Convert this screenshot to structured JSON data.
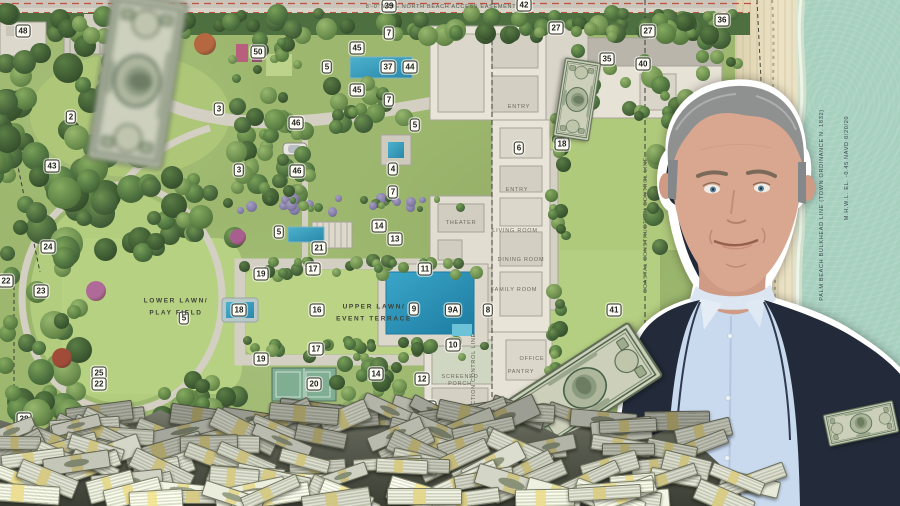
{
  "scene": {
    "description_labels": {
      "easement": "8'-0\" WIDE NORTH BEACH ACCESS EASEMENT"
    },
    "plan": {
      "badges": [
        {
          "n": "48",
          "x": 23,
          "y": 31
        },
        {
          "n": "50",
          "x": 258,
          "y": 52
        },
        {
          "n": "2",
          "x": 71,
          "y": 117
        },
        {
          "n": "3",
          "x": 219,
          "y": 109
        },
        {
          "n": "3",
          "x": 239,
          "y": 170
        },
        {
          "n": "46",
          "x": 296,
          "y": 123
        },
        {
          "n": "46",
          "x": 297,
          "y": 171
        },
        {
          "n": "43",
          "x": 52,
          "y": 166
        },
        {
          "n": "24",
          "x": 48,
          "y": 247
        },
        {
          "n": "22",
          "x": 6,
          "y": 281
        },
        {
          "n": "23",
          "x": 41,
          "y": 291
        },
        {
          "n": "25",
          "x": 99,
          "y": 373
        },
        {
          "n": "22",
          "x": 99,
          "y": 384
        },
        {
          "n": "28",
          "x": 24,
          "y": 419
        },
        {
          "n": "30",
          "x": 143,
          "y": 424
        },
        {
          "n": "29",
          "x": 413,
          "y": 425
        },
        {
          "n": "39",
          "x": 389,
          "y": 6
        },
        {
          "n": "42",
          "x": 524,
          "y": 5
        },
        {
          "n": "27",
          "x": 556,
          "y": 28
        },
        {
          "n": "27",
          "x": 648,
          "y": 31
        },
        {
          "n": "36",
          "x": 722,
          "y": 20
        },
        {
          "n": "35",
          "x": 607,
          "y": 59
        },
        {
          "n": "40",
          "x": 643,
          "y": 64
        },
        {
          "n": "7",
          "x": 389,
          "y": 33
        },
        {
          "n": "7",
          "x": 389,
          "y": 100
        },
        {
          "n": "7",
          "x": 393,
          "y": 192
        },
        {
          "n": "45",
          "x": 357,
          "y": 48
        },
        {
          "n": "45",
          "x": 357,
          "y": 90
        },
        {
          "n": "5",
          "x": 327,
          "y": 67
        },
        {
          "n": "37",
          "x": 388,
          "y": 67
        },
        {
          "n": "44",
          "x": 410,
          "y": 67
        },
        {
          "n": "5",
          "x": 415,
          "y": 125
        },
        {
          "n": "4",
          "x": 393,
          "y": 169
        },
        {
          "n": "6",
          "x": 519,
          "y": 148
        },
        {
          "n": "18",
          "x": 562,
          "y": 144
        },
        {
          "n": "5",
          "x": 279,
          "y": 232
        },
        {
          "n": "21",
          "x": 319,
          "y": 248
        },
        {
          "n": "14",
          "x": 379,
          "y": 226
        },
        {
          "n": "13",
          "x": 395,
          "y": 239
        },
        {
          "n": "11",
          "x": 425,
          "y": 269
        },
        {
          "n": "17",
          "x": 313,
          "y": 269
        },
        {
          "n": "19",
          "x": 261,
          "y": 274
        },
        {
          "n": "18",
          "x": 239,
          "y": 310
        },
        {
          "n": "5",
          "x": 184,
          "y": 318
        },
        {
          "n": "16",
          "x": 317,
          "y": 310
        },
        {
          "n": "9",
          "x": 414,
          "y": 309
        },
        {
          "n": "9A",
          "x": 453,
          "y": 310
        },
        {
          "n": "8",
          "x": 488,
          "y": 310
        },
        {
          "n": "41",
          "x": 614,
          "y": 310
        },
        {
          "n": "10",
          "x": 453,
          "y": 345
        },
        {
          "n": "17",
          "x": 316,
          "y": 349
        },
        {
          "n": "19",
          "x": 261,
          "y": 359
        },
        {
          "n": "20",
          "x": 314,
          "y": 384
        },
        {
          "n": "14",
          "x": 376,
          "y": 374
        },
        {
          "n": "12",
          "x": 422,
          "y": 379
        },
        {
          "n": "15",
          "x": 429,
          "y": 407
        }
      ],
      "labels": [
        {
          "text": "8'-0\" WIDE NORTH BEACH ACCESS EASEMENT",
          "x": 441,
          "y": 7,
          "rot": 0,
          "cls": "lbl-line"
        },
        {
          "text": "LOWER LAWN/",
          "x": 176,
          "y": 301,
          "rot": 0,
          "cls": "lbl-area"
        },
        {
          "text": "PLAY FIELD",
          "x": 176,
          "y": 313,
          "rot": 0,
          "cls": "lbl-area"
        },
        {
          "text": "UPPER LAWN/",
          "x": 374,
          "y": 307,
          "rot": 0,
          "cls": "lbl-area"
        },
        {
          "text": "EVENT TERRACE",
          "x": 374,
          "y": 319,
          "rot": 0,
          "cls": "lbl-area"
        },
        {
          "text": "ENTRY",
          "x": 519,
          "y": 107,
          "rot": 0,
          "cls": "lbl-room"
        },
        {
          "text": "ENTRY",
          "x": 517,
          "y": 190,
          "rot": 0,
          "cls": "lbl-room"
        },
        {
          "text": "THEATER",
          "x": 461,
          "y": 223,
          "rot": 0,
          "cls": "lbl-room"
        },
        {
          "text": "LIVING ROOM",
          "x": 515,
          "y": 231,
          "rot": 0,
          "cls": "lbl-room"
        },
        {
          "text": "DINING ROOM",
          "x": 521,
          "y": 260,
          "rot": 0,
          "cls": "lbl-room"
        },
        {
          "text": "FAMILY ROOM",
          "x": 514,
          "y": 290,
          "rot": 0,
          "cls": "lbl-room"
        },
        {
          "text": "OFFICE",
          "x": 532,
          "y": 359,
          "rot": 0,
          "cls": "lbl-room"
        },
        {
          "text": "PANTRY",
          "x": 521,
          "y": 372,
          "rot": 0,
          "cls": "lbl-room"
        },
        {
          "text": "SCREENED",
          "x": 460,
          "y": 377,
          "rot": 0,
          "cls": "lbl-room"
        },
        {
          "text": "PORCH",
          "x": 460,
          "y": 384,
          "rot": 0,
          "cls": "lbl-room"
        },
        {
          "text": "GARAGE",
          "x": 459,
          "y": 414,
          "rot": 0,
          "cls": "lbl-room"
        },
        {
          "text": "COASTAL CONSTRUCTION CONTROL LINE",
          "x": 646,
          "y": 225,
          "rot": -90,
          "cls": "lbl-line"
        },
        {
          "text": "CONSTRUCTION CONTROL LINE",
          "x": 474,
          "y": 385,
          "rot": -90,
          "cls": "lbl-line"
        },
        {
          "text": "PALM BEACH BULKHEAD LINE (TOWN ORDINANCE N. 1832)",
          "x": 822,
          "y": 205,
          "rot": -90,
          "cls": "lbl-line lbl-right"
        },
        {
          "text": "M.H.W.L. EL. -0.45 NAVD 8/20/20",
          "x": 847,
          "y": 168,
          "rot": -90,
          "cls": "lbl-line lbl-right"
        }
      ]
    },
    "icons": [
      {
        "name": "dollar-bill",
        "meaning": "flying US one-dollar banknote"
      },
      {
        "name": "money-stack",
        "meaning": "banded stack of US currency"
      },
      {
        "name": "car-graphic",
        "meaning": "car on the driveway"
      },
      {
        "name": "person-cutout",
        "meaning": "man in navy suit and light blue shirt, sticker-style white outline"
      }
    ],
    "colors": {
      "lawn": "#b5cd80",
      "hedge": "#4e6f3f",
      "ocean": "#a7d0bf",
      "sand": "#e9dfc1",
      "pool_water": "#2f9fc4",
      "suit": "#222a38",
      "shirt": "#c9d9ee",
      "bill_paper": "#ccd0ba",
      "money_band": "#d6c97f",
      "badge_bg": "#fdfdf6",
      "red_line": "#c34f3f"
    }
  }
}
